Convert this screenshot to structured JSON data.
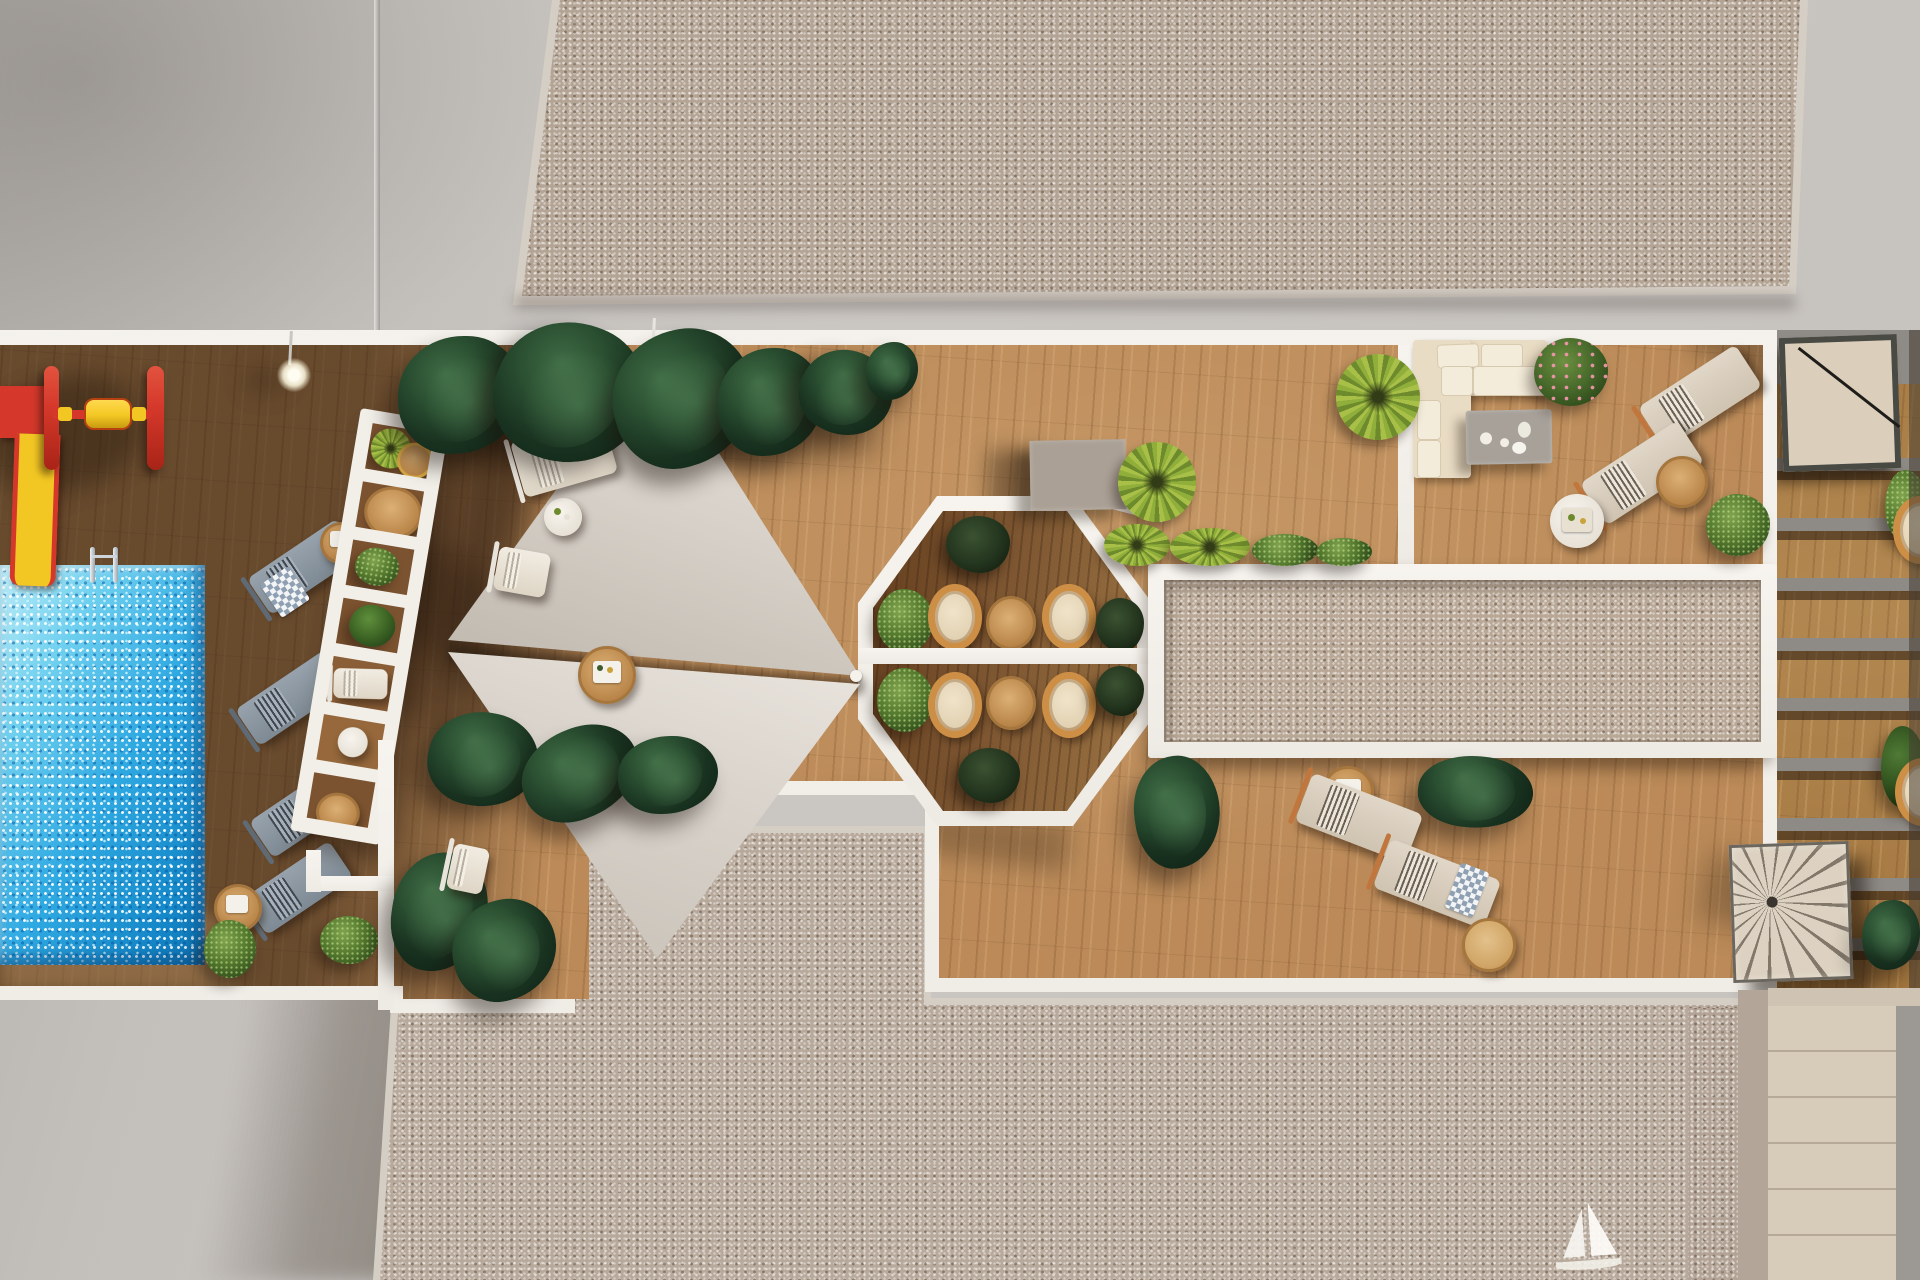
{
  "meta": {
    "title": "Rooftop amenity terrace — aerial top-down 3D render",
    "view": "top-down architectural visualization, long afternoon shadows"
  },
  "palette": {
    "concrete": "#c6c2be",
    "concrete-shadow": "#a19d99",
    "gravel": "#b3a495",
    "gravel-light": "#d5cec5",
    "white": "#f4f1ec",
    "deck": "#bb8a58",
    "deck-shadow": "#3a2713",
    "pool-1": "#bfeef8",
    "pool-2": "#2fa9e2",
    "pool-3": "#0e74b4",
    "sail": "#d8d2ca",
    "foliage-dark": "#1d3423",
    "foliage-green": "#55772f",
    "palm": "#a8bf48",
    "rattan": "#cd8f45",
    "wood-table": "#c49257",
    "cream": "#e9dcc4",
    "copper": "#c0763c",
    "play-red": "#d5382a",
    "play-yellow": "#f3c723",
    "taupe": "#aaa095",
    "beige": "#d7cbba"
  },
  "areas": {
    "roof_top": {
      "label": "Upper roof — gravel"
    },
    "roof_bottom": {
      "label": "Lower roof — gravel"
    },
    "terrace": {
      "label": "Main rooftop terrace deck"
    },
    "pool": {
      "label": "Swimming pool"
    },
    "playground": {
      "label": "Children playground"
    },
    "pergola": {
      "label": "White slatted pergola"
    },
    "sail_lounge": {
      "label": "Shade-sail sun deck"
    },
    "octagon": {
      "label": "Octagonal dining gazebo"
    },
    "skylight": {
      "label": "Gravel skylight strip"
    },
    "family_lounge": {
      "label": "Corner sofa lounge"
    },
    "sun_deck": {
      "label": "Sun lounger deck"
    },
    "stairs": {
      "label": "Spiral stair + lower terraces"
    },
    "boat_mark": {
      "label": "Sailboat motif"
    }
  },
  "inventory": {
    "shade_sails": 2,
    "pool_loungers_gray": 4,
    "white_loungers": 3,
    "beige_loungers": 4,
    "octagon_chairs": 8,
    "octagon_tables": 4,
    "side_tables": 8,
    "plant_clusters": 18,
    "corner_sofa": 1,
    "playground_items": 2,
    "spiral_stair": 1
  }
}
